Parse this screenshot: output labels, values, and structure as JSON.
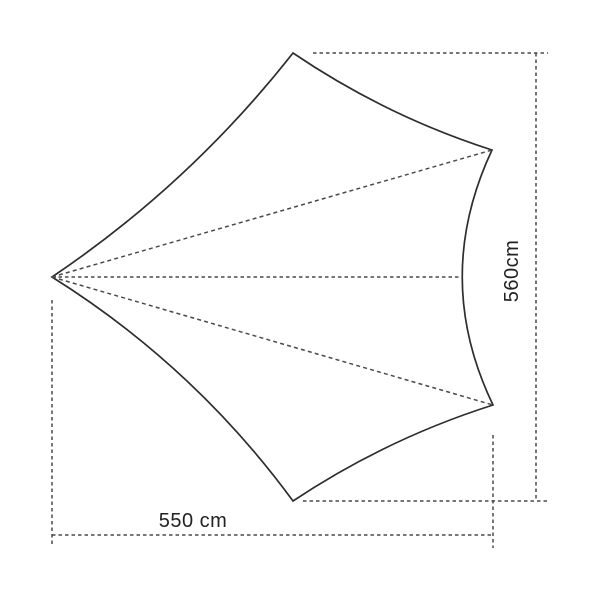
{
  "diagram": {
    "kind": "tarp-dimension-drawing",
    "height_dimension": {
      "label": "560cm",
      "value": 560,
      "unit": "cm"
    },
    "width_dimension": {
      "label": "550 cm",
      "value": 550,
      "unit": "cm"
    },
    "colors": {
      "background": "#ffffff",
      "outline": "#2e2e2e",
      "dotted_line": "#4a4a4a",
      "label_text": "#222222"
    }
  }
}
